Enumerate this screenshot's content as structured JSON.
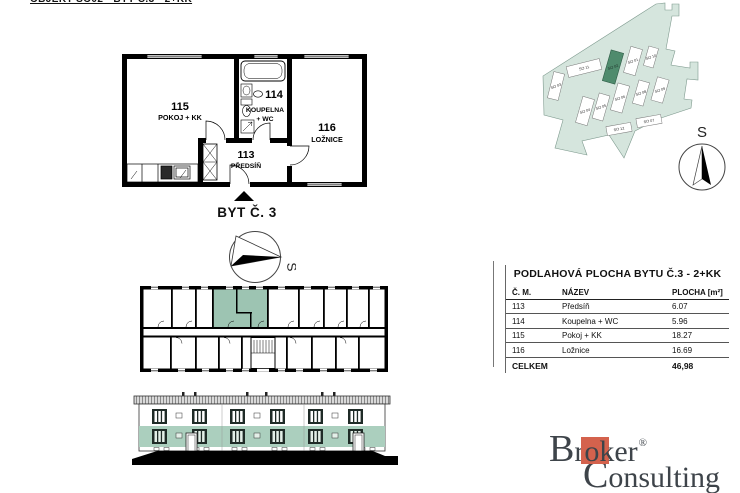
{
  "header": {
    "title": "OBJEKT SO02 - BYT Č.3 - 2+KK"
  },
  "apartment_plan": {
    "caption": "BYT Č. 3",
    "rooms": {
      "r113": {
        "number": "113",
        "name": "PŘEDSÍŇ"
      },
      "r114": {
        "number": "114",
        "name_line1": "KOUPELNA",
        "name_line2": "+ WC"
      },
      "r115": {
        "number": "115",
        "name": "POKOJ + KK"
      },
      "r116": {
        "number": "116",
        "name": "LOŽNICE"
      }
    }
  },
  "orientation": {
    "compass_label": "S"
  },
  "site_plan": {
    "compass_label": "S",
    "highlighted_building": "SO 02",
    "buildings": [
      {
        "id": "SO 11"
      },
      {
        "id": "SO 02"
      },
      {
        "id": "SO 01"
      },
      {
        "id": "SO 10"
      },
      {
        "id": "SO 03"
      },
      {
        "id": "SO 04"
      },
      {
        "id": "SO 05"
      },
      {
        "id": "SO 06"
      },
      {
        "id": "SO 08"
      },
      {
        "id": "SO 09"
      },
      {
        "id": "SO 12"
      },
      {
        "id": "SO 07"
      }
    ]
  },
  "area_table": {
    "title": "PODLAHOVÁ PLOCHA BYTU Č.3 - 2+KK",
    "columns": [
      "Č. M.",
      "NÁZEV",
      "PLOCHA [m²]"
    ],
    "rows": [
      {
        "cm": "113",
        "nazev": "Předsíň",
        "plocha": "6.07"
      },
      {
        "cm": "114",
        "nazev": "Koupelna + WC",
        "plocha": "5.96"
      },
      {
        "cm": "115",
        "nazev": "Pokoj + KK",
        "plocha": "18.27"
      },
      {
        "cm": "116",
        "nazev": "Ložnice",
        "plocha": "16.69"
      }
    ],
    "total_label": "CELKEM",
    "total_value": "46,98"
  },
  "logo": {
    "line1_parts": [
      "B",
      "r",
      "ok",
      "er"
    ],
    "registered": "®",
    "line2_parts": [
      "C",
      "onsulting"
    ]
  },
  "colors": {
    "site_area_fill": "#d5e5dd",
    "highlight_building": "#4f8b6d",
    "unit_highlight": "#9dc4b2",
    "elevation_floor_band": "#abcfbe",
    "logo_accent": "#d4624d",
    "logo_text": "#3e444a"
  }
}
